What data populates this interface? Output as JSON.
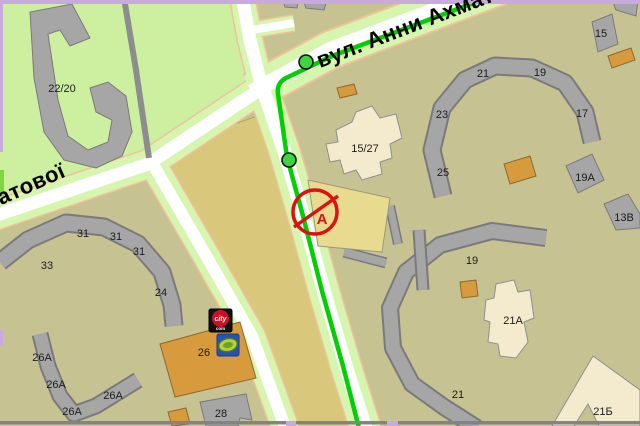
{
  "map": {
    "streets": {
      "akhmatova_full": "вул. Анни Ахматової",
      "akhmatova_lower_visible": "матової"
    },
    "marker": {
      "route_point_label": "А"
    },
    "logos": {
      "citycom_top": "city",
      "citycom_bottom": "com"
    },
    "buildings": {
      "b22_20": "22/20",
      "b33": "33",
      "b31": "31",
      "b24": "24",
      "b26a": "26А",
      "b26": "26",
      "b28": "28",
      "b15_27": "15/27",
      "b23": "23",
      "b25": "25",
      "b21": "21",
      "b19": "19",
      "b17": "17",
      "b15": "15",
      "b19a": "19А",
      "b13v": "13В",
      "b21a": "21А",
      "b21b": "21Б"
    },
    "colors": {
      "route_line": "#00cf00",
      "marker_red": "#dd1111",
      "park_green": "#cdf0a0",
      "residential_khaki": "#c7c292",
      "field_dark_khaki": "#d9c77c",
      "boundary_purple": "#c9aade",
      "building_gray": "#a6a6a6",
      "building_cream": "#f4ebcf",
      "building_orange": "#d79a3d",
      "building_yellow": "#e8db90",
      "road_white": "#ffffff",
      "verge_green": "#d6f5ae",
      "logo_blue": "#2353b9"
    }
  }
}
